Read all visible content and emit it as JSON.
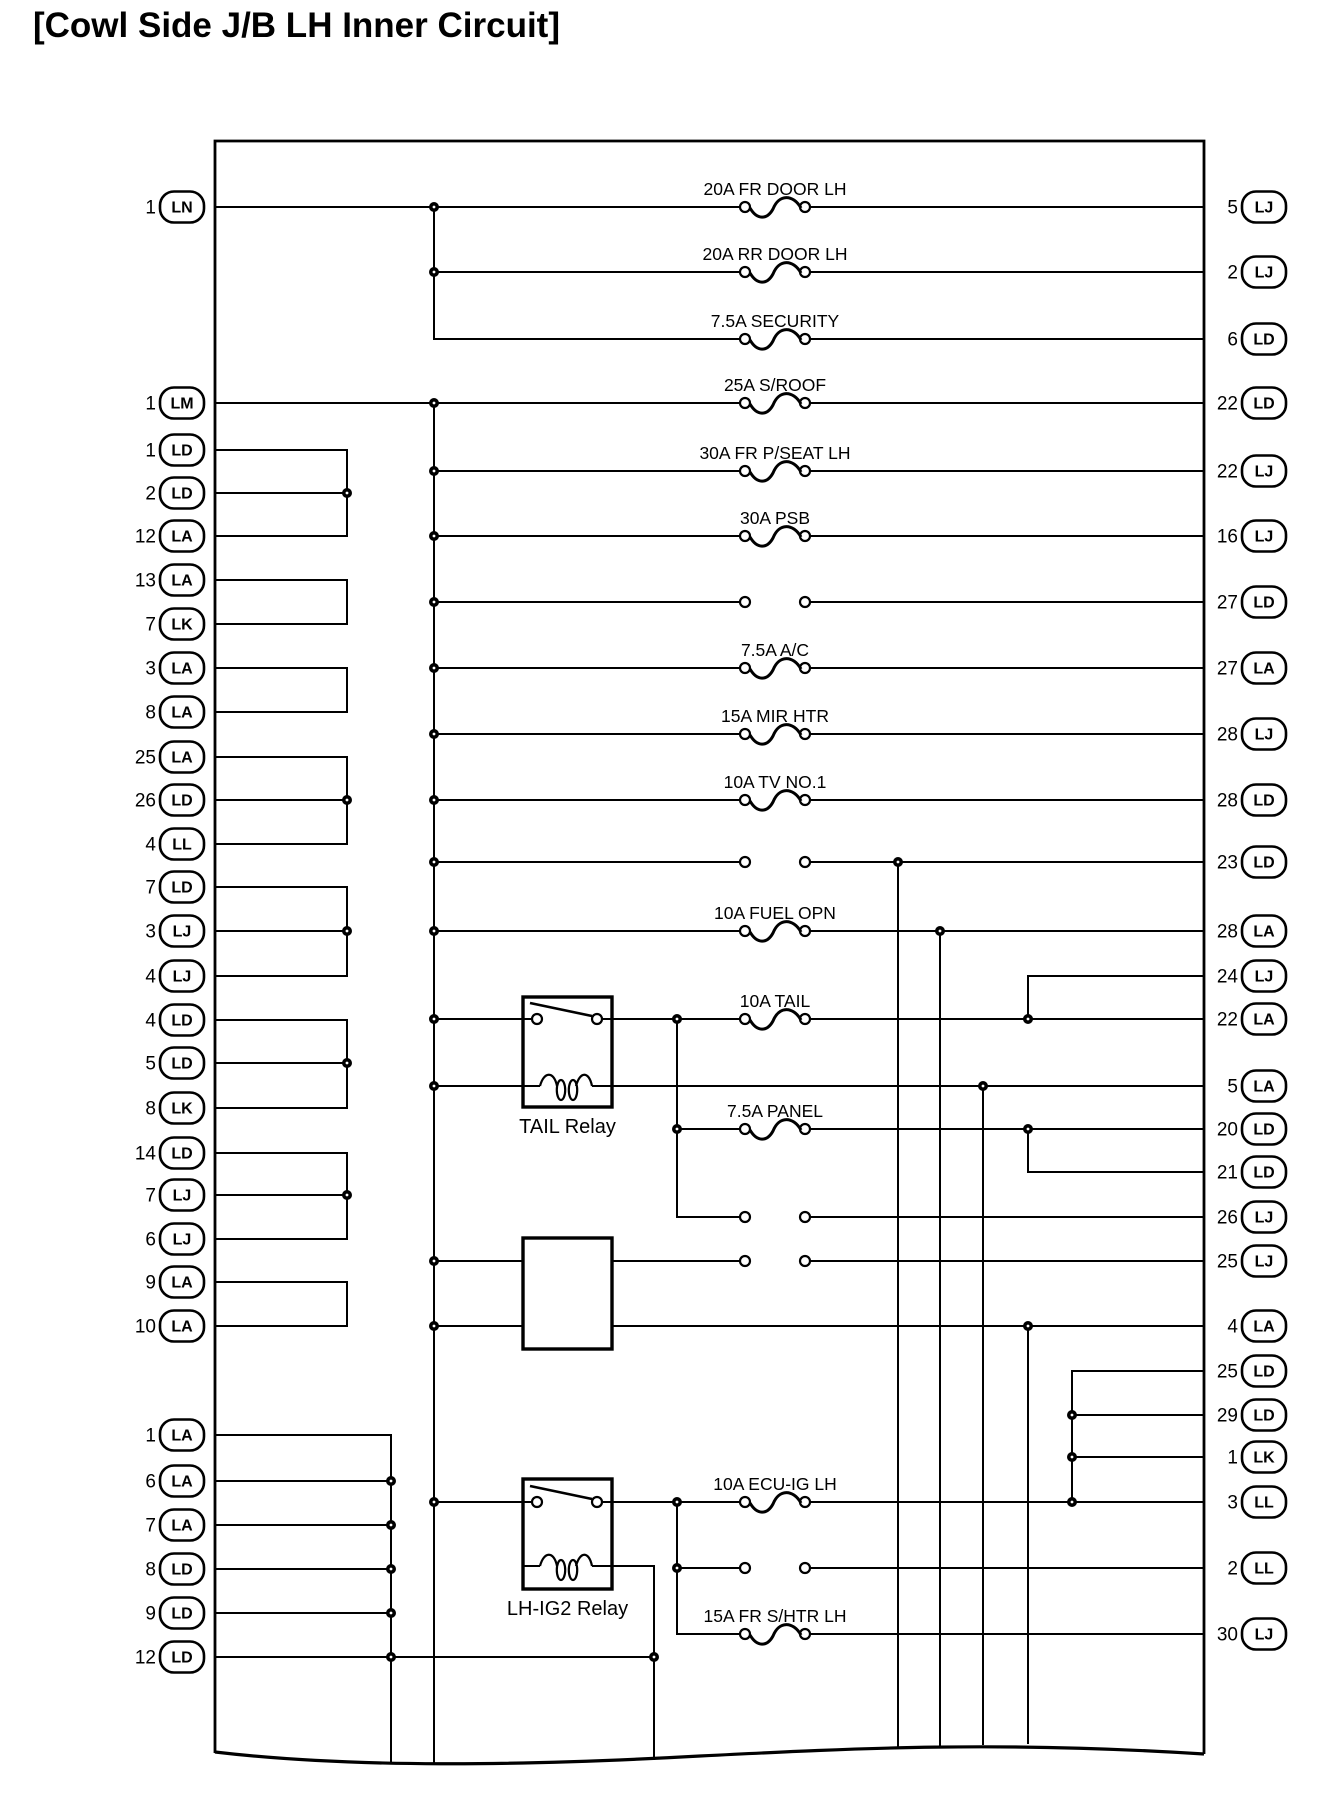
{
  "title": "[Cowl Side J/B LH Inner Circuit]",
  "colors": {
    "ink": "#000000",
    "background": "#ffffff"
  },
  "diagram": {
    "box": {
      "left": 215,
      "top": 141,
      "right": 1204,
      "bottom": 1753,
      "wavy_bottom": "M215 1752 C 350 1768, 520 1766, 700 1756 C 860 1748, 1000 1741, 1204 1754"
    },
    "left_connectors": [
      {
        "pin": "1",
        "code": "LN",
        "y": 207
      },
      {
        "pin": "1",
        "code": "LM",
        "y": 403
      },
      {
        "pin": "1",
        "code": "LD",
        "y": 450
      },
      {
        "pin": "2",
        "code": "LD",
        "y": 493
      },
      {
        "pin": "12",
        "code": "LA",
        "y": 536
      },
      {
        "pin": "13",
        "code": "LA",
        "y": 580
      },
      {
        "pin": "7",
        "code": "LK",
        "y": 624
      },
      {
        "pin": "3",
        "code": "LA",
        "y": 668
      },
      {
        "pin": "8",
        "code": "LA",
        "y": 712
      },
      {
        "pin": "25",
        "code": "LA",
        "y": 757
      },
      {
        "pin": "26",
        "code": "LD",
        "y": 800
      },
      {
        "pin": "4",
        "code": "LL",
        "y": 844
      },
      {
        "pin": "7",
        "code": "LD",
        "y": 887
      },
      {
        "pin": "3",
        "code": "LJ",
        "y": 931
      },
      {
        "pin": "4",
        "code": "LJ",
        "y": 976
      },
      {
        "pin": "4",
        "code": "LD",
        "y": 1020
      },
      {
        "pin": "5",
        "code": "LD",
        "y": 1063
      },
      {
        "pin": "8",
        "code": "LK",
        "y": 1108
      },
      {
        "pin": "14",
        "code": "LD",
        "y": 1153
      },
      {
        "pin": "7",
        "code": "LJ",
        "y": 1195
      },
      {
        "pin": "6",
        "code": "LJ",
        "y": 1239
      },
      {
        "pin": "9",
        "code": "LA",
        "y": 1282
      },
      {
        "pin": "10",
        "code": "LA",
        "y": 1326
      },
      {
        "pin": "1",
        "code": "LA",
        "y": 1435
      },
      {
        "pin": "6",
        "code": "LA",
        "y": 1481
      },
      {
        "pin": "7",
        "code": "LA",
        "y": 1525
      },
      {
        "pin": "8",
        "code": "LD",
        "y": 1569
      },
      {
        "pin": "9",
        "code": "LD",
        "y": 1613
      },
      {
        "pin": "12",
        "code": "LD",
        "y": 1657
      }
    ],
    "right_connectors": [
      {
        "pin": "5",
        "code": "LJ",
        "y": 207
      },
      {
        "pin": "2",
        "code": "LJ",
        "y": 272
      },
      {
        "pin": "6",
        "code": "LD",
        "y": 339
      },
      {
        "pin": "22",
        "code": "LD",
        "y": 403
      },
      {
        "pin": "22",
        "code": "LJ",
        "y": 471
      },
      {
        "pin": "16",
        "code": "LJ",
        "y": 536
      },
      {
        "pin": "27",
        "code": "LD",
        "y": 602
      },
      {
        "pin": "27",
        "code": "LA",
        "y": 668
      },
      {
        "pin": "28",
        "code": "LJ",
        "y": 734
      },
      {
        "pin": "28",
        "code": "LD",
        "y": 800
      },
      {
        "pin": "23",
        "code": "LD",
        "y": 862
      },
      {
        "pin": "28",
        "code": "LA",
        "y": 931
      },
      {
        "pin": "24",
        "code": "LJ",
        "y": 976
      },
      {
        "pin": "22",
        "code": "LA",
        "y": 1019
      },
      {
        "pin": "5",
        "code": "LA",
        "y": 1086
      },
      {
        "pin": "20",
        "code": "LD",
        "y": 1129
      },
      {
        "pin": "21",
        "code": "LD",
        "y": 1172
      },
      {
        "pin": "26",
        "code": "LJ",
        "y": 1217
      },
      {
        "pin": "25",
        "code": "LJ",
        "y": 1261
      },
      {
        "pin": "4",
        "code": "LA",
        "y": 1326
      },
      {
        "pin": "25",
        "code": "LD",
        "y": 1371
      },
      {
        "pin": "29",
        "code": "LD",
        "y": 1415
      },
      {
        "pin": "1",
        "code": "LK",
        "y": 1457
      },
      {
        "pin": "3",
        "code": "LL",
        "y": 1502
      },
      {
        "pin": "2",
        "code": "LL",
        "y": 1568
      },
      {
        "pin": "30",
        "code": "LJ",
        "y": 1634
      }
    ],
    "fuse_rows": [
      {
        "y": 207,
        "label": "20A FR DOOR LH",
        "fused": true
      },
      {
        "y": 272,
        "label": "20A RR DOOR LH",
        "fused": true
      },
      {
        "y": 339,
        "label": "7.5A SECURITY",
        "fused": true
      },
      {
        "y": 403,
        "label": "25A S/ROOF",
        "fused": true
      },
      {
        "y": 471,
        "label": "30A FR P/SEAT LH",
        "fused": true
      },
      {
        "y": 536,
        "label": "30A PSB",
        "fused": true
      },
      {
        "y": 602,
        "label": "",
        "fused": false
      },
      {
        "y": 668,
        "label": "7.5A A/C",
        "fused": true
      },
      {
        "y": 734,
        "label": "15A MIR HTR",
        "fused": true
      },
      {
        "y": 800,
        "label": "10A TV NO.1",
        "fused": true
      },
      {
        "y": 862,
        "label": "",
        "fused": false
      },
      {
        "y": 931,
        "label": "10A FUEL OPN",
        "fused": true
      },
      {
        "y": 1019,
        "label": "10A TAIL",
        "fused": true
      },
      {
        "y": 1129,
        "label": "7.5A PANEL",
        "fused": true
      },
      {
        "y": 1217,
        "label": "",
        "fused": false
      },
      {
        "y": 1261,
        "label": "",
        "fused": false
      },
      {
        "y": 1502,
        "label": "10A ECU-IG LH",
        "fused": true
      },
      {
        "y": 1568,
        "label": "",
        "fused": false
      },
      {
        "y": 1634,
        "label": "15A FR S/HTR LH",
        "fused": true
      }
    ],
    "fuse_cx": {
      "left": 745,
      "right": 805,
      "label_x": 775
    },
    "relays": [
      {
        "name": "TAIL Relay",
        "x": 523,
        "y": 997,
        "w": 89,
        "h": 110,
        "switch_y": 1019,
        "coil_y": 1086,
        "label_y": 1133
      },
      {
        "name": "LH-IG2 Relay",
        "x": 523,
        "y": 1479,
        "w": 89,
        "h": 110,
        "switch_y": 1502,
        "coil_y": 1566,
        "label_y": 1615
      },
      {
        "name": "",
        "x": 523,
        "y": 1238,
        "w": 89,
        "h": 111
      }
    ],
    "wires_h": [
      [
        215,
        740,
        207
      ],
      [
        810,
        1204,
        207
      ],
      [
        434,
        740,
        272
      ],
      [
        810,
        1204,
        272
      ],
      [
        434,
        740,
        339
      ],
      [
        810,
        1204,
        339
      ],
      [
        215,
        740,
        403
      ],
      [
        810,
        1204,
        403
      ],
      [
        434,
        740,
        471
      ],
      [
        810,
        1204,
        471
      ],
      [
        434,
        740,
        536
      ],
      [
        810,
        1204,
        536
      ],
      [
        434,
        740,
        602
      ],
      [
        810,
        1204,
        602
      ],
      [
        434,
        740,
        668
      ],
      [
        810,
        1204,
        668
      ],
      [
        434,
        740,
        734
      ],
      [
        810,
        1204,
        734
      ],
      [
        434,
        740,
        800
      ],
      [
        810,
        1204,
        800
      ],
      [
        434,
        740,
        862
      ],
      [
        810,
        1204,
        862
      ],
      [
        434,
        740,
        931
      ],
      [
        810,
        1204,
        931
      ],
      [
        1028,
        1204,
        976
      ],
      [
        434,
        523,
        1019
      ],
      [
        523,
        532,
        1019
      ],
      [
        602,
        612,
        1019
      ],
      [
        612,
        740,
        1019
      ],
      [
        810,
        1204,
        1019
      ],
      [
        434,
        523,
        1086
      ],
      [
        612,
        1204,
        1086
      ],
      [
        677,
        740,
        1129
      ],
      [
        810,
        1204,
        1129
      ],
      [
        1028,
        1204,
        1172
      ],
      [
        677,
        740,
        1217
      ],
      [
        810,
        1204,
        1217
      ],
      [
        434,
        523,
        1261
      ],
      [
        612,
        740,
        1261
      ],
      [
        810,
        1204,
        1261
      ],
      [
        434,
        523,
        1326
      ],
      [
        612,
        1204,
        1326
      ],
      [
        1072,
        1204,
        1371
      ],
      [
        1072,
        1204,
        1415
      ],
      [
        1072,
        1204,
        1457
      ],
      [
        434,
        523,
        1502
      ],
      [
        523,
        532,
        1502
      ],
      [
        602,
        612,
        1502
      ],
      [
        612,
        740,
        1502
      ],
      [
        810,
        1204,
        1502
      ],
      [
        677,
        740,
        1568
      ],
      [
        810,
        1204,
        1568
      ],
      [
        677,
        740,
        1634
      ],
      [
        810,
        1204,
        1634
      ],
      [
        612,
        654,
        1566
      ],
      [
        215,
        347,
        450
      ],
      [
        215,
        347,
        493
      ],
      [
        215,
        347,
        536
      ],
      [
        215,
        347,
        580
      ],
      [
        215,
        347,
        624
      ],
      [
        215,
        347,
        668
      ],
      [
        215,
        347,
        712
      ],
      [
        215,
        347,
        757
      ],
      [
        215,
        347,
        800
      ],
      [
        215,
        347,
        844
      ],
      [
        215,
        347,
        887
      ],
      [
        215,
        347,
        931
      ],
      [
        215,
        347,
        976
      ],
      [
        215,
        347,
        1020
      ],
      [
        215,
        347,
        1063
      ],
      [
        215,
        347,
        1108
      ],
      [
        215,
        347,
        1153
      ],
      [
        215,
        347,
        1195
      ],
      [
        215,
        347,
        1239
      ],
      [
        215,
        347,
        1282
      ],
      [
        215,
        347,
        1326
      ],
      [
        215,
        391,
        1435
      ],
      [
        215,
        391,
        1481
      ],
      [
        215,
        391,
        1525
      ],
      [
        215,
        391,
        1569
      ],
      [
        215,
        391,
        1613
      ],
      [
        215,
        654,
        1657
      ]
    ],
    "wires_v": [
      [
        434,
        207,
        339
      ],
      [
        434,
        403,
        1764
      ],
      [
        347,
        450,
        536
      ],
      [
        347,
        580,
        624
      ],
      [
        347,
        668,
        712
      ],
      [
        347,
        757,
        844
      ],
      [
        347,
        887,
        976
      ],
      [
        347,
        1020,
        1108
      ],
      [
        347,
        1153,
        1239
      ],
      [
        347,
        1282,
        1326
      ],
      [
        391,
        1435,
        1763
      ],
      [
        654,
        1566,
        1759
      ],
      [
        677,
        1019,
        1217
      ],
      [
        677,
        1502,
        1634
      ],
      [
        898,
        862,
        1746
      ],
      [
        940,
        931,
        1745
      ],
      [
        983,
        1086,
        1744
      ],
      [
        1028,
        976,
        1019
      ],
      [
        1028,
        1129,
        1172
      ],
      [
        1028,
        1326,
        1743
      ],
      [
        1072,
        1371,
        1502
      ]
    ],
    "junctions": [
      [
        434,
        207
      ],
      [
        434,
        272
      ],
      [
        434,
        403
      ],
      [
        434,
        471
      ],
      [
        434,
        536
      ],
      [
        434,
        602
      ],
      [
        434,
        668
      ],
      [
        434,
        734
      ],
      [
        434,
        800
      ],
      [
        434,
        862
      ],
      [
        434,
        931
      ],
      [
        434,
        1019
      ],
      [
        434,
        1086
      ],
      [
        434,
        1261
      ],
      [
        434,
        1326
      ],
      [
        434,
        1502
      ],
      [
        347,
        493
      ],
      [
        347,
        800
      ],
      [
        347,
        931
      ],
      [
        347,
        1063
      ],
      [
        347,
        1195
      ],
      [
        391,
        1481
      ],
      [
        391,
        1525
      ],
      [
        391,
        1569
      ],
      [
        391,
        1613
      ],
      [
        391,
        1657
      ],
      [
        654,
        1657
      ],
      [
        677,
        1019
      ],
      [
        677,
        1129
      ],
      [
        677,
        1502
      ],
      [
        677,
        1568
      ],
      [
        898,
        862
      ],
      [
        940,
        931
      ],
      [
        983,
        1086
      ],
      [
        1028,
        1019
      ],
      [
        1028,
        1129
      ],
      [
        1028,
        1326
      ],
      [
        1072,
        1415
      ],
      [
        1072,
        1457
      ],
      [
        1072,
        1502
      ]
    ],
    "oval": {
      "w": 44,
      "h": 31,
      "rx": 14,
      "left_cx": 182,
      "right_cx": 1264,
      "left_pin_x": 156,
      "right_pin_x": 1238
    }
  }
}
